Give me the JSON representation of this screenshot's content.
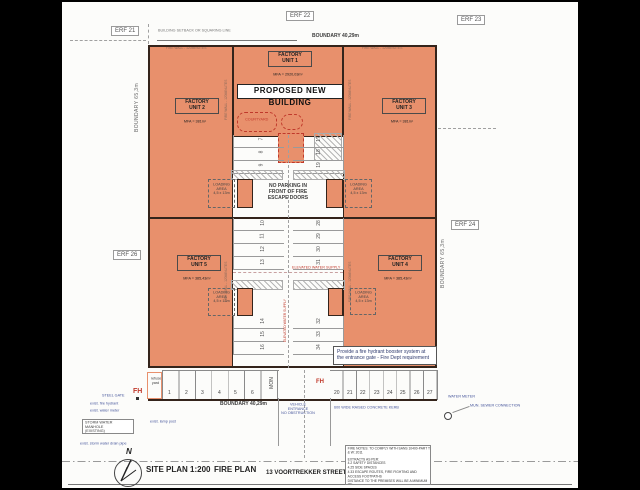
{
  "erf": {
    "e21": "ERF 21",
    "e22": "ERF 22",
    "e23": "ERF 23",
    "e24": "ERF 24",
    "e26": "ERF 26"
  },
  "boundary": {
    "top": "BOUNDARY 40,29m",
    "bottom": "BOUNDARY 40,29m",
    "left": "BOUNDARY 65,3m",
    "right": "BOUNDARY 65,3m",
    "setback": "BUILDING SETBACK OR SQUARING LINE"
  },
  "building": {
    "banner": "PROPOSED NEW BUILDING",
    "units": [
      {
        "label": "FACTORY\nUNIT 1",
        "mfa": "MFA = 2920,03m²"
      },
      {
        "label": "FACTORY\nUNIT 2",
        "mfa": "MFA = 381m²"
      },
      {
        "label": "FACTORY\nUNIT 3",
        "mfa": "MFA = 381m²"
      },
      {
        "label": "FACTORY\nUNIT 4",
        "mfa": "MFA = 385,43m²"
      },
      {
        "label": "FACTORY\nUNIT 5",
        "mfa": "MFA = 385,43m²"
      }
    ],
    "fire_wall": "FIRE WALL - 120MINUTES",
    "no_parking": "NO PARKING IN\nFRONT OF FIRE\nESCAPE DOORS",
    "loading": "LOADING AREA\n4,5 x 13m",
    "courtyard": "COURTYARD",
    "elevated_water": "ELEVATED WATER SUPPLY"
  },
  "notes": {
    "hydrant": "Provide a fire hydrant booster system at\nthe entrance gate - Fire Dept requirement",
    "header": "FIRE NOTES: TO COMPLY WITH SANS 10400-PART T & W: 2011",
    "lines": [
      "EXTRACTS AS PER:",
      "4.2 SAFETY DISTANCES",
      "4.25 SIDE SPACES",
      "4.33 ESCAPE ROUTES, FIRE FIGHTING AND ACCESS FOOTPATHS",
      "DISTANCE TO THE PREMISES WILL BE A MINIMUM OF",
      "DESIGN & PROCESS"
    ]
  },
  "street_annotations": {
    "steel_gate": "STEEL GATE",
    "fire_hydrant": "exist. fire hydrant",
    "water_meter_left": "exist. water meter",
    "lamp_post": "exist. lamp post",
    "storm_manhole": "STORM WATER MANHOLE\n(EXISTING)",
    "storm_pipe": "exist. storm water drain pipe",
    "water_meter_right": "WATER METER",
    "sewer": "MUN. SEWER CONNECTION",
    "vehicle_entrance": "VEHICLE ENTRANCE\nNO OBSTRUCTION",
    "kerb": "600 WIDE RAISED CONCRETE KERB",
    "fh": "FH",
    "mon": "MON",
    "refuse": "refuse\nyard"
  },
  "parking": {
    "street_left": [
      "1",
      "2",
      "3",
      "4",
      "5",
      "6"
    ],
    "street_right": [
      "20",
      "21",
      "22",
      "23",
      "24",
      "25",
      "26",
      "27"
    ],
    "center_left": [
      "7",
      "8",
      "9",
      "10",
      "11",
      "12",
      "13",
      "14",
      "15",
      "16"
    ],
    "center_right": [
      "17",
      "18",
      "19",
      "28",
      "29",
      "30",
      "31",
      "32",
      "33",
      "34"
    ]
  },
  "title": {
    "north": "N",
    "site_plan": "SITE PLAN 1:200",
    "fire_plan": "FIRE PLAN",
    "street": "13 VOORTREKKER STREET"
  },
  "colors": {
    "unit_fill": "#E8906C",
    "wall": "#34241B",
    "accent_red": "#C0392B",
    "annotation_blue": "#44549A"
  }
}
